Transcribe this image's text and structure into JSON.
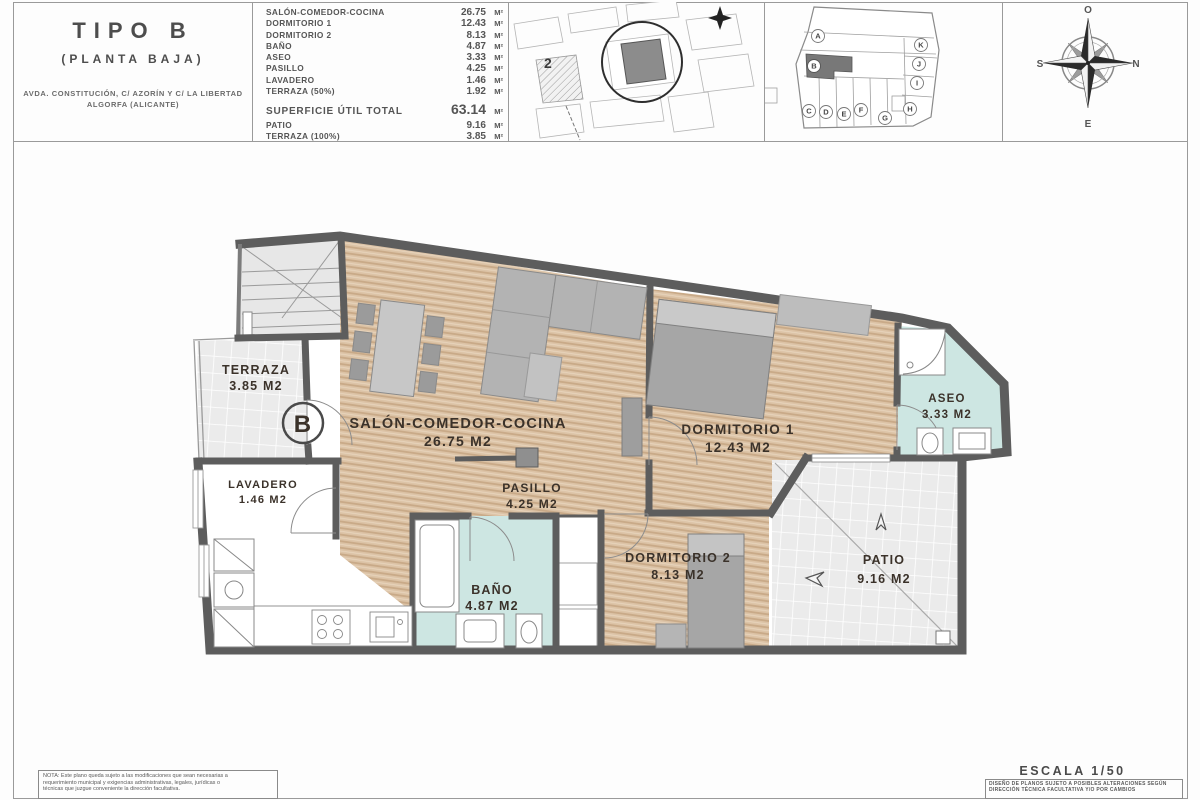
{
  "title_block": {
    "title": "TIPO B",
    "subtitle": "(PLANTA BAJA)",
    "address_line1": "AVDA. CONSTITUCIÓN, C/ AZORÍN Y C/ LA LIBERTAD",
    "address_line2": "ALGORFA (ALICANTE)"
  },
  "areas_table": {
    "unit": "M²",
    "rows": [
      {
        "label": "SALÓN-COMEDOR-COCINA",
        "value": "26.75"
      },
      {
        "label": "DORMITORIO 1",
        "value": "12.43"
      },
      {
        "label": "DORMITORIO 2",
        "value": "8.13"
      },
      {
        "label": "BAÑO",
        "value": "4.87"
      },
      {
        "label": "ASEO",
        "value": "3.33"
      },
      {
        "label": "PASILLO",
        "value": "4.25"
      },
      {
        "label": "LAVADERO",
        "value": "1.46"
      },
      {
        "label": "TERRAZA (50%)",
        "value": "1.92"
      }
    ],
    "total_label": "SUPERFICIE ÚTIL TOTAL",
    "total_value": "63.14",
    "extra_rows": [
      {
        "label": "PATIO",
        "value": "9.16"
      },
      {
        "label": "TERRAZA (100%)",
        "value": "3.85"
      }
    ]
  },
  "site_map": {
    "plot_number": "2"
  },
  "key_plan": {
    "letters": [
      "A",
      "B",
      "C",
      "D",
      "E",
      "F",
      "G",
      "H",
      "I",
      "J",
      "K"
    ],
    "highlighted_unit": "B"
  },
  "compass": {
    "top": "O",
    "right": "N",
    "bottom": "E",
    "left": "S"
  },
  "floor_plan": {
    "unit_marker": "B",
    "rooms": [
      {
        "name": "TERRAZA",
        "area": "3.85 M2"
      },
      {
        "name": "SALÓN-COMEDOR-COCINA",
        "area": "26.75 M2"
      },
      {
        "name": "DORMITORIO 1",
        "area": "12.43 M2"
      },
      {
        "name": "ASEO",
        "area": "3.33 M2"
      },
      {
        "name": "LAVADERO",
        "area": "1.46 M2"
      },
      {
        "name": "PASILLO",
        "area": "4.25 M2"
      },
      {
        "name": "BAÑO",
        "area": "4.87 M2"
      },
      {
        "name": "DORMITORIO 2",
        "area": "8.13 M2"
      },
      {
        "name": "PATIO",
        "area": "9.16 M2"
      }
    ]
  },
  "footer": {
    "note_line1": "NOTA: Este plano queda sujeto a las modificaciones que sean necesarias a",
    "note_line2": "requerimiento municipal y exigencias administrativas, legales, jurídicas o",
    "note_line3": "técnicas que juzgue conveniente la dirección facultativa.",
    "scale_label": "ESCALA 1/50",
    "disclaimer_line1": "DISEÑO DE PLANOS SUJETO A POSIBLES ALTERACIONES SEGÚN",
    "disclaimer_line2": "DIRECCIÓN TÉCNICA FACULTATIVA Y/O POR CAMBIOS"
  },
  "colors": {
    "wall": "#5d5d5d",
    "wood_floor": "#dcc3a6",
    "wet_room": "#cde6e2",
    "tile": "#ebebeb",
    "furniture": "#a9a9a9",
    "label_text": "#3b322a"
  }
}
